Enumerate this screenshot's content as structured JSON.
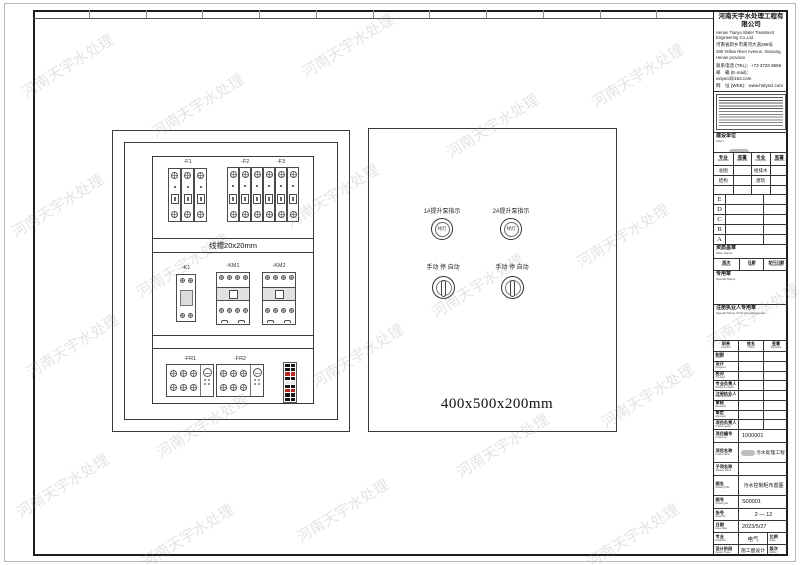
{
  "watermark": "河南天宇水处理",
  "drawing": {
    "cabinet": {
      "breakers": [
        "-F1",
        "-F2",
        "-F3"
      ],
      "duct_label": "线槽20x20mm",
      "relay": "-K1",
      "contactors": [
        "-KM1",
        "-KM2"
      ],
      "overloads": [
        "-FR1",
        "-FR2"
      ]
    },
    "panel": {
      "light1_label": "1#提升泵指示",
      "light2_label": "2#提升泵指示",
      "lamp_text": "绿灯",
      "switch_label": "手动 停 自动",
      "dimension": "400x500x200mm"
    }
  },
  "title_block": {
    "company": {
      "name_cn": "河南天宇水处理工程有限公司",
      "name_en": "Henan Tianyu Water Treatment Engineering Co.,Ltd.",
      "address_cn": "河南省新乡市黄河大道288号",
      "address_en": "288 Yellow River Avenue, Xinxiang, Henan province",
      "tel": "联系电话 (TEL)：+73 3733 8666",
      "email": "邮　箱 (E-mail)：xxtyscl@163.com",
      "web": "网　址 (WEB)：www.hntyscl.com"
    },
    "client": {
      "cn": "建设单位",
      "en": "Client",
      "value": "有限公司"
    },
    "discipline_table": {
      "headers": [
        {
          "cn": "专业",
          "en": "Discipline"
        },
        {
          "cn": "签署",
          "en": "Signature"
        },
        {
          "cn": "专业",
          "en": "Discipline"
        },
        {
          "cn": "签署",
          "en": "Signature"
        }
      ],
      "row1": [
        "总图",
        "",
        "给排水",
        ""
      ],
      "row2": [
        "结构",
        "",
        "建筑",
        ""
      ]
    },
    "revision_letters": [
      "E",
      "D",
      "C",
      "B",
      "A"
    ],
    "plate_stamp": {
      "cn": "资质盖章",
      "en": "Plate Stamp"
    },
    "revision_header": [
      {
        "cn": "版次",
        "en": "Revision"
      },
      {
        "cn": "日期",
        "en": "Date"
      },
      {
        "cn": "发行日期",
        "en": "Issued Date"
      }
    ],
    "special_stamp": {
      "cn": "专用章",
      "en": "Special Stamp"
    },
    "registered_stamp": {
      "cn": "注册执业人专用章",
      "en": "Special Stamp Of Person Registered"
    },
    "sign_header": [
      {
        "cn": "职责",
        "en": "Function"
      },
      {
        "cn": "姓名",
        "en": "Name"
      },
      {
        "cn": "签署",
        "en": "Signature"
      }
    ],
    "sign_rows": [
      {
        "cn": "制图",
        "en": "Drawn"
      },
      {
        "cn": "设计",
        "en": "Designed"
      },
      {
        "cn": "校对",
        "en": "Checked"
      },
      {
        "cn": "专业负责人",
        "en": "Discipline Leader"
      },
      {
        "cn": "注册执业人",
        "en": "Regi. Engineer"
      },
      {
        "cn": "审核",
        "en": "Reviewed"
      },
      {
        "cn": "审定",
        "en": "Approved"
      },
      {
        "cn": "项目负责人",
        "en": "Project Leader"
      }
    ],
    "info": {
      "project_no": {
        "cn": "项目编号",
        "en": "Project No.",
        "value": "1000001"
      },
      "project_name": {
        "cn": "项目名称",
        "en": "Project Name",
        "value": "污水处理工程"
      },
      "subitem": {
        "cn": "子项名称",
        "en": "Subitem Name",
        "value": ""
      },
      "drawing_title": {
        "cn": "图名",
        "en": "Drawing Title",
        "value": "污水控制柜布置图"
      },
      "drawing_no": {
        "cn": "图号",
        "en": "Drawing No.",
        "value": "S00001"
      },
      "sheet_no": {
        "cn": "张号",
        "en": "Sheet No.",
        "value": "2 — 12"
      },
      "date": {
        "cn": "日期",
        "en": "Issue Date",
        "value": "2023/5/27"
      },
      "discipline": {
        "cn": "专业",
        "en": "Discipline",
        "value": "电气"
      },
      "scale": {
        "cn": "比例",
        "en": "Scale",
        "value": ""
      },
      "phase": {
        "cn": "设计阶段",
        "en": "Design Phase",
        "value": "施工图设计"
      },
      "edition": {
        "cn": "版次",
        "en": "Edition",
        "value": ""
      }
    }
  }
}
